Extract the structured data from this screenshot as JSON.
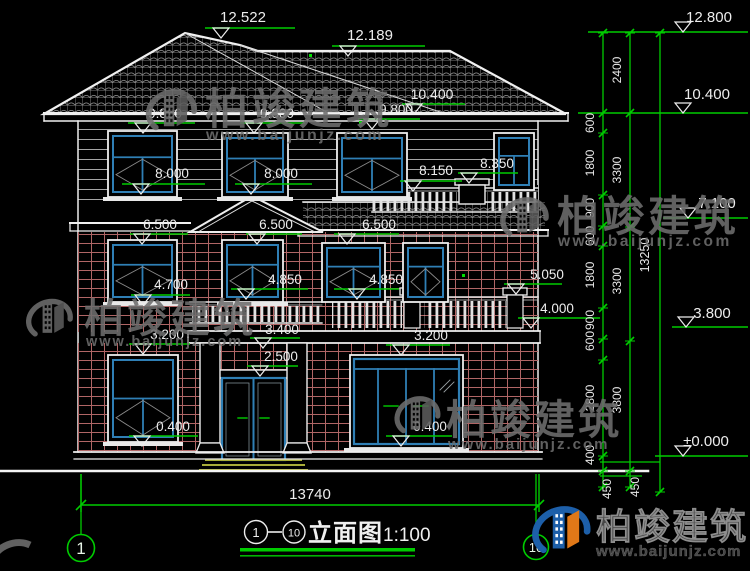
{
  "drawing": {
    "footer": {
      "dim_total": "13740",
      "axis_left": "1",
      "axis_right": "10",
      "title_axis_start": "1",
      "title_axis_dash": "—",
      "title_axis_end": "10",
      "title": "立面图",
      "scale": "1:100"
    },
    "watermark": {
      "brand": "柏竣建筑",
      "site": "www.baijunjz.com"
    },
    "logo": {
      "brand": "柏竣建筑",
      "site": "www.baijunjz.com"
    }
  },
  "markers": {
    "building": [
      {
        "name": "peak-left",
        "text": "12.522",
        "tx": 243,
        "ty": 22,
        "lx1": 205,
        "lx2": 295,
        "ly": 28,
        "ax": 221,
        "fs": 15
      },
      {
        "name": "ridge-main",
        "text": "12.189",
        "tx": 370,
        "ty": 40,
        "lx1": 332,
        "lx2": 425,
        "ly": 46,
        "ax": 348,
        "fs": 15
      },
      {
        "name": "eave-main",
        "text": "10.400",
        "tx": 432,
        "ty": 99,
        "lx1": 402,
        "lx2": 465,
        "ly": 104,
        "ax": 414,
        "fs": 14
      },
      {
        "name": "lvl-9800-a",
        "text": "9.800",
        "tx": 165,
        "ty": 118,
        "lx1": 128,
        "lx2": 195,
        "ly": 123,
        "ax": 143
      },
      {
        "name": "lvl-9800-b",
        "text": "9.800",
        "tx": 277,
        "ty": 118,
        "lx1": 240,
        "lx2": 305,
        "ly": 123,
        "ax": 254
      },
      {
        "name": "lvl-9800-c",
        "text": "9.800",
        "tx": 396,
        "ty": 114,
        "lx1": 358,
        "lx2": 420,
        "ly": 119,
        "ax": 372
      },
      {
        "name": "lvl-8000-a",
        "text": "8.000",
        "tx": 172,
        "ty": 178,
        "lx1": 122,
        "lx2": 205,
        "ly": 184,
        "ax": 141
      },
      {
        "name": "lvl-8000-b",
        "text": "8.000",
        "tx": 281,
        "ty": 178,
        "lx1": 235,
        "lx2": 312,
        "ly": 184,
        "ax": 251
      },
      {
        "name": "lvl-8350",
        "text": "8.350",
        "tx": 497,
        "ty": 168,
        "lx1": 458,
        "lx2": 518,
        "ly": 173,
        "ax": 469
      },
      {
        "name": "lvl-8150",
        "text": "8.150",
        "tx": 436,
        "ty": 175,
        "lx1": 400,
        "lx2": 462,
        "ly": 181,
        "ax": 413
      },
      {
        "name": "lvl-6500-a",
        "text": "6.500",
        "tx": 160,
        "ty": 229,
        "lx1": 130,
        "lx2": 188,
        "ly": 234,
        "ax": 142
      },
      {
        "name": "lvl-6500-b",
        "text": "6.500",
        "tx": 276,
        "ty": 229,
        "lx1": 246,
        "lx2": 302,
        "ly": 234,
        "ax": 257
      },
      {
        "name": "lvl-6500-c",
        "text": "6.500",
        "tx": 379,
        "ty": 229,
        "lx1": 334,
        "lx2": 399,
        "ly": 234,
        "ax": 347
      },
      {
        "name": "lvl-5050",
        "text": "5.050",
        "tx": 547,
        "ty": 279,
        "lx1": 504,
        "lx2": 562,
        "ly": 284,
        "ax": 516
      },
      {
        "name": "lvl-4850-a",
        "text": "4.850",
        "tx": 285,
        "ty": 284,
        "lx1": 231,
        "lx2": 308,
        "ly": 289,
        "ax": 246
      },
      {
        "name": "lvl-4850-b",
        "text": "4.850",
        "tx": 386,
        "ty": 284,
        "lx1": 334,
        "lx2": 399,
        "ly": 289,
        "ax": 357
      },
      {
        "name": "lvl-4700",
        "text": "4.700",
        "tx": 171,
        "ty": 289,
        "lx1": 131,
        "lx2": 190,
        "ly": 295,
        "ax": 143
      },
      {
        "name": "lvl-4000",
        "text": "4.000",
        "tx": 557,
        "ty": 313,
        "lx1": 518,
        "lx2": 600,
        "ly": 318,
        "ax": 531
      },
      {
        "name": "lvl-3400",
        "text": "3.400",
        "tx": 282,
        "ty": 334,
        "lx1": 250,
        "lx2": 300,
        "ly": 338,
        "ax": 263
      },
      {
        "name": "lvl-3200-a",
        "text": "3.200",
        "tx": 167,
        "ty": 339,
        "lx1": 129,
        "lx2": 190,
        "ly": 344,
        "ax": 143
      },
      {
        "name": "lvl-3200-b",
        "text": "3.200",
        "tx": 431,
        "ty": 340,
        "lx1": 386,
        "lx2": 450,
        "ly": 345,
        "ax": 401
      },
      {
        "name": "lvl-2500",
        "text": "2.500",
        "tx": 281,
        "ty": 361,
        "lx1": 247,
        "lx2": 298,
        "ly": 366,
        "ax": 260
      },
      {
        "name": "lvl-0400-a",
        "text": "0.400",
        "tx": 173,
        "ty": 431,
        "lx1": 129,
        "lx2": 198,
        "ly": 436,
        "ax": 142
      },
      {
        "name": "lvl-0400-b",
        "text": "0.400",
        "tx": 430,
        "ty": 431,
        "lx1": 386,
        "lx2": 452,
        "ly": 436,
        "ax": 401
      }
    ],
    "right_column": [
      {
        "name": "r-12800",
        "text": "12.800",
        "tx": 709,
        "ty": 22,
        "lx1": 588,
        "lx2": 748,
        "ly": 32,
        "ax": 683,
        "side": -1,
        "fs": 15
      },
      {
        "name": "r-10400",
        "text": "10.400",
        "tx": 707,
        "ty": 99,
        "lx1": 578,
        "lx2": 748,
        "ly": 113,
        "ax": 683,
        "side": -1,
        "fs": 15
      },
      {
        "name": "r-7100",
        "text": "7.100",
        "tx": 717,
        "ty": 208,
        "lx1": 663,
        "lx2": 748,
        "ly": 218,
        "ax": 688,
        "side": -1,
        "fs": 15
      },
      {
        "name": "r-3800",
        "text": "3.800",
        "tx": 712,
        "ty": 318,
        "lx1": 672,
        "lx2": 748,
        "ly": 327,
        "ax": 686,
        "side": -1,
        "fs": 15
      },
      {
        "name": "r-0000",
        "text": "±0.000",
        "tx": 706,
        "ty": 446,
        "lx1": 655,
        "lx2": 748,
        "ly": 456,
        "ax": 683,
        "side": -1,
        "fs": 15
      }
    ]
  },
  "dim_chain": {
    "inner": [
      {
        "text": "600",
        "y": 123
      },
      {
        "text": "1800",
        "y": 163
      },
      {
        "text": "900",
        "y": 208
      },
      {
        "text": "600",
        "y": 236
      },
      {
        "text": "1800",
        "y": 275
      },
      {
        "text": "900",
        "y": 320
      },
      {
        "text": "600",
        "y": 341
      },
      {
        "text": "2800",
        "y": 398
      },
      {
        "text": "400",
        "y": 455
      }
    ],
    "outer": [
      {
        "text": "2400",
        "y": 70
      },
      {
        "text": "3300",
        "y": 170
      },
      {
        "text": "3300",
        "y": 281
      },
      {
        "text": "3800",
        "y": 400
      }
    ],
    "total": [
      {
        "text": "13250",
        "y": 255
      }
    ],
    "base": [
      {
        "text": "450",
        "x": 611,
        "y": 489
      },
      {
        "text": "450",
        "x": 639,
        "y": 487
      }
    ]
  },
  "windows": [
    {
      "x": 108,
      "y": 131,
      "w": 69,
      "h": 66,
      "sill": true
    },
    {
      "x": 222,
      "y": 133,
      "w": 66,
      "h": 64,
      "sill": true
    },
    {
      "x": 337,
      "y": 133,
      "w": 70,
      "h": 64,
      "sill": true
    },
    {
      "x": 494,
      "y": 133,
      "w": 40,
      "h": 57,
      "narrow": true
    },
    {
      "x": 108,
      "y": 240,
      "w": 69,
      "h": 62,
      "sill": true
    },
    {
      "x": 222,
      "y": 240,
      "w": 61,
      "h": 62,
      "sill": true
    },
    {
      "x": 322,
      "y": 243,
      "w": 63,
      "h": 59
    },
    {
      "x": 403,
      "y": 243,
      "w": 45,
      "h": 59
    },
    {
      "x": 108,
      "y": 355,
      "w": 70,
      "h": 87,
      "tall": true,
      "sill": true
    }
  ],
  "colors": {
    "green": "#00CC00",
    "white": "#F0F0F0",
    "window_blue": "#2F7FB5",
    "brick": "#B06565",
    "roof_line": "#ABABAB",
    "siding_line": "#A5A5A5",
    "watermark_gray": "#6E6E6E",
    "logo_blue": "#1D5FA9",
    "logo_orange": "#E07818",
    "step_olive": "#A9AD39"
  }
}
